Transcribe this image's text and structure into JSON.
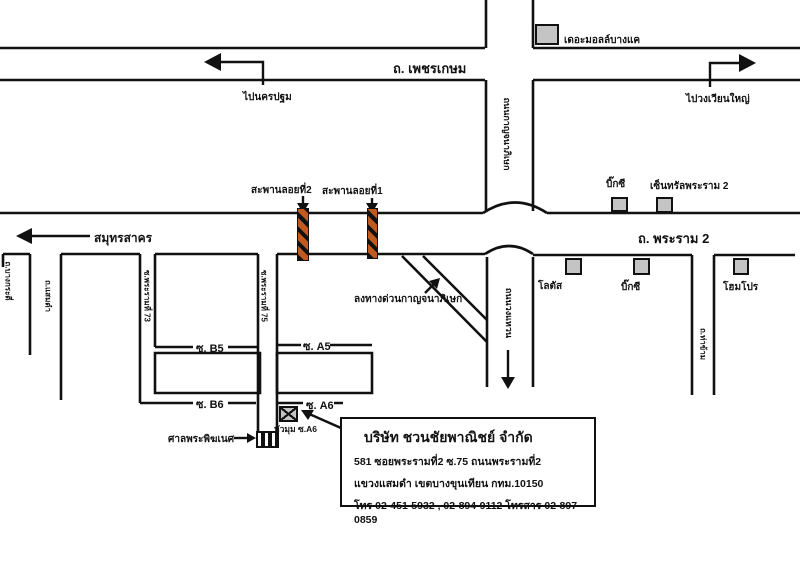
{
  "map": {
    "roads": {
      "phetkasem_label": "ถ. เพชรเกษม",
      "rama2_label": "ถ. พระราม 2",
      "ring_upper_label": "ถนนกาญจนาภิเษก",
      "ring_lower_label": "ถนนวงแหวน",
      "soi_bangkradi_label": "ถ.บางกระดี่",
      "soi_samaedam_label": "ถ.แสมดำ",
      "soi_rama73_label": "ซ.พระรามที่ 73",
      "soi_rama75_label": "ซ.พระรามที่ 75",
      "soi_thakham_label": "ถ.ท่าข้าม",
      "soi_b5_label": "ซ. B5",
      "soi_a5_label": "ซ. A5",
      "soi_b6_label": "ซ. B6",
      "soi_a6_label": "ซ. A6"
    },
    "directions": {
      "to_nakhonpathom": "ไปนครปฐม",
      "to_wongwianyai": "ไปวงเวียนใหญ่",
      "to_samutsakhon": "สมุทรสาคร",
      "expressway_exit": "ลงทางด่วนกาญจนาภิเษก"
    },
    "bridges": {
      "bridge2_label": "สะพานลอยที่2",
      "bridge1_label": "สะพานลอยที่1"
    },
    "landmarks": [
      {
        "label": "เดอะมอลล์บางแค"
      },
      {
        "label": "บิ๊กซี"
      },
      {
        "label": "เซ็นทรัลพระราม 2"
      },
      {
        "label": "โลตัส"
      },
      {
        "label": "บิ๊กซี"
      },
      {
        "label": "โฮมโปร"
      }
    ],
    "shrine_label": "ศาลพระพิฆเนศ",
    "corner_label": "หัวมุม ซ.A6"
  },
  "info_box": {
    "company": "บริษัท ชวนชัยพาณิชย์ จำกัด",
    "address1": "581 ซอยพระรามที่2 ซ.75  ถนนพระรามที่2",
    "address2": "แขวงแสมดำ เขตบางขุนเทียน  กทม.10150",
    "phone": "โทร 02-451-5932 , 02-894-9112  โทรสาร 02-897-0859"
  },
  "colors": {
    "road_line": "#111111",
    "bridge_orange": "#c05a1e",
    "building_gray": "#c4c4c4"
  }
}
